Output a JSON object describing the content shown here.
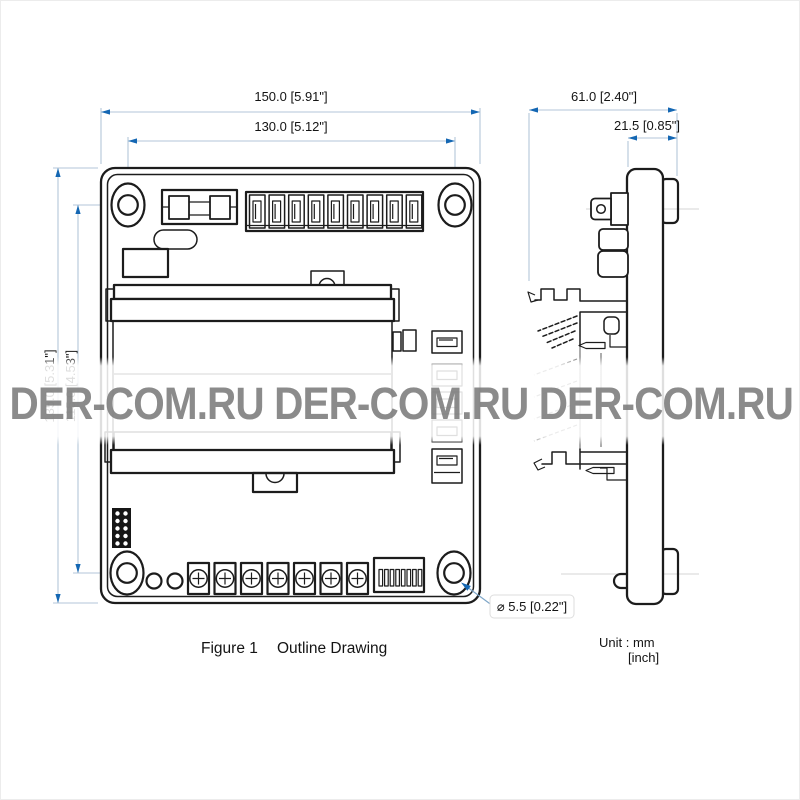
{
  "watermark": {
    "text": "DER-COM.RU DER-COM.RU DER-COM.RU"
  },
  "caption": {
    "figure_label": "Figure 1",
    "title": "Outline Drawing"
  },
  "units": {
    "line1": "Unit : mm",
    "line2": "[inch]"
  },
  "dims": {
    "front_width": "150.0 [5.91\"]",
    "front_width_holes": "130.0 [5.12\"]",
    "front_height": "135.0 [5.31\"]",
    "front_height_holes": "115.0 [4.53\"]",
    "side_depth": "61.0 [2.40\"]",
    "side_plate": "21.5 [0.85\"]",
    "hole_dia": "⌀ 5.5 [0.22\"]"
  },
  "colors": {
    "line": "#1c1c1c",
    "dimension_line": "#b3c6d8",
    "arrow": "#1467b3",
    "watermark_gray": "#7c7c7c"
  }
}
